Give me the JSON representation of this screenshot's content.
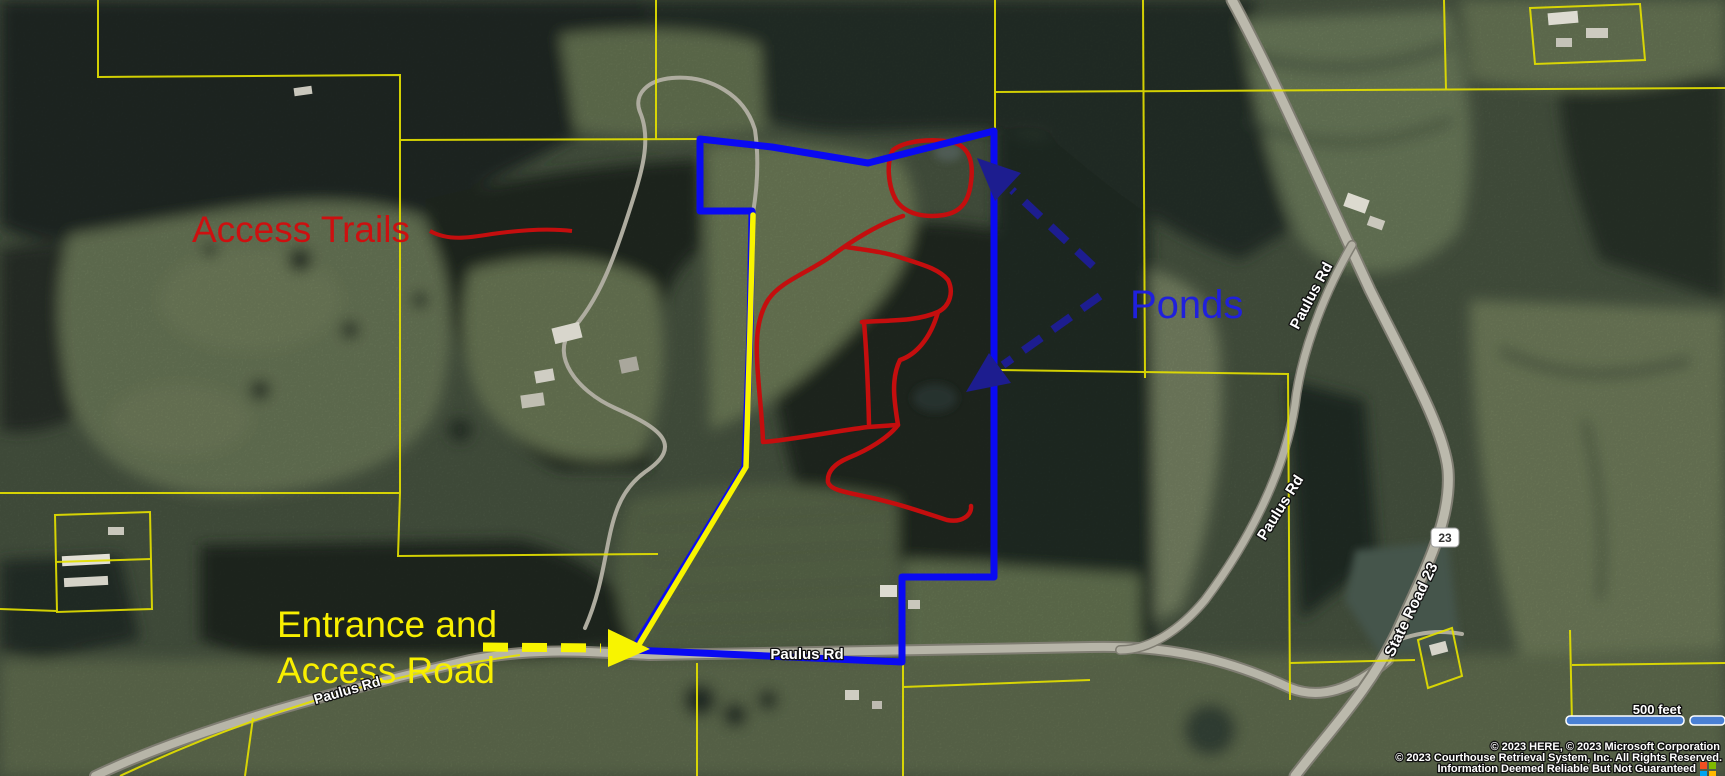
{
  "map": {
    "annotations": {
      "access_trails": "Access Trails",
      "ponds": "Ponds",
      "entrance_line1": "Entrance and",
      "entrance_line2": "Access Road"
    },
    "road_labels": {
      "paulus_rd": "Paulus Rd",
      "state_road_23": "State Road 23",
      "route_shield": "23"
    },
    "scale_bar": {
      "label": "500 feet"
    },
    "attribution": {
      "line1": "© 2023 HERE, © 2023 Microsoft Corporation",
      "line2": "© 2023 Courthouse Retrieval System, Inc. All Rights Reserved.",
      "line3": "Information Deemed Reliable But Not Guaranteed"
    },
    "colors": {
      "boundary_blue": "#0a0af2",
      "access_road_yellow": "#f8f400",
      "trail_red": "#c40e0e",
      "arrow_navy": "#1d1d8f",
      "parcel_yellow": "#e3df00",
      "annotation_red": "#cc1010",
      "annotation_blue": "#2020dc",
      "annotation_yellow": "#f8ef00",
      "scale_bar_blue": "#4a80d4"
    }
  }
}
